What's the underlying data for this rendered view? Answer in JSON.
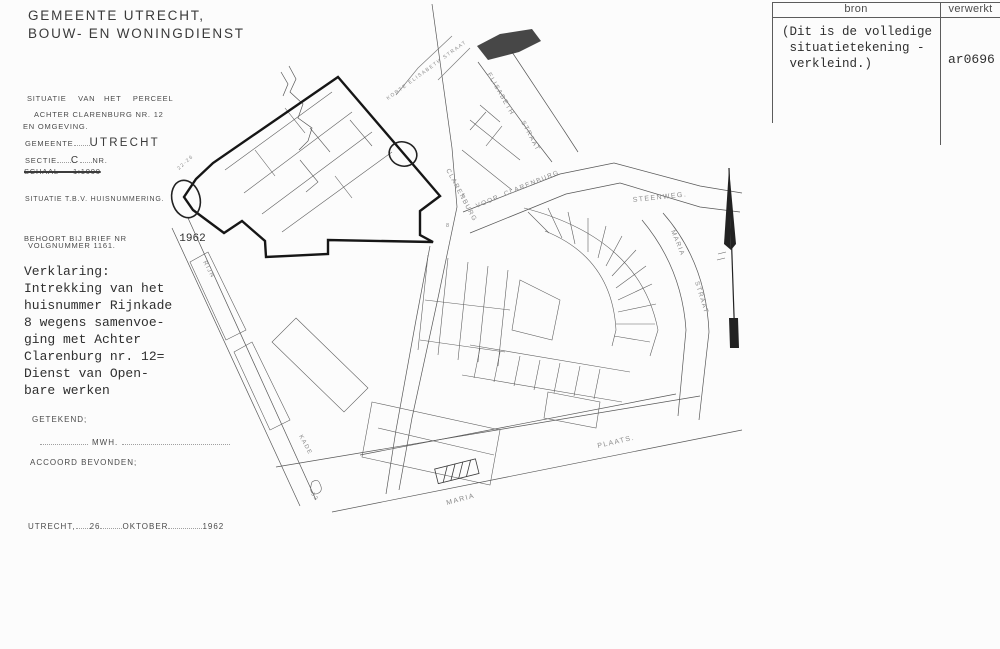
{
  "colors": {
    "ink": "#3f3f3f",
    "map_line": "#555555",
    "heavy_line": "#141414",
    "label_gray": "#8b8b8b"
  },
  "header": {
    "line1": "GEMEENTE UTRECHT,",
    "line2": "BOUW- EN WONINGDIENST"
  },
  "ref_table": {
    "col_bron": "bron",
    "col_verwerkt": "verwerkt",
    "bron_lines": [
      "(Dit is de volledige",
      " situatietekening -",
      " verkleind.)"
    ],
    "verwerkt_value": "ar0696"
  },
  "form": {
    "situatie_label": "SITUATIE    VAN   HET    PERCEEL",
    "perceel_line1": "ACHTER CLARENBURG NR. 12",
    "perceel_line2": "EN OMGEVING.",
    "gemeente_label": "GEMEENTE",
    "gemeente_value": "UTRECHT",
    "sectie_label": "SECTIE",
    "sectie_value": "C",
    "nr_label": "NR.",
    "schaal_line": "SCHAAL     1:1000",
    "situatie_tbv": "SITUATIE T.B.V. HUISNUMMERING.",
    "behoort_label": "BEHOORT BIJ BRIEF NR",
    "behoort_year": "1962",
    "volgnummer": "VOLGNUMMER 1161.",
    "verklaring_lines": [
      "Verklaring:",
      "Intrekking van het",
      "huisnummer Rijnkade",
      "8 wegens samenvoe-",
      "ging met Achter",
      "Clarenburg nr. 12=",
      "Dienst van Open-",
      "bare werken"
    ],
    "getekend_label": "GETEKEND;",
    "getekend_initials": "MWH.",
    "accoord_label": "ACCOORD BEVONDEN;",
    "date_city": "UTRECHT,",
    "date_day": "26",
    "date_month": "OKTOBER",
    "date_year": "1962"
  },
  "map": {
    "labels": [
      {
        "text": "CLARENBURG"
      },
      {
        "text": "VOOR"
      },
      {
        "text": "CLARENBURG"
      },
      {
        "text": "ELISABETH"
      },
      {
        "text": "STRAAT"
      },
      {
        "text": "KORTE ELISABETH STRAAT"
      },
      {
        "text": "STEENWEG."
      },
      {
        "text": "MARIA"
      },
      {
        "text": "STRAAT"
      },
      {
        "text": "PLAATS."
      },
      {
        "text": "MARIA"
      },
      {
        "text": "RIJN"
      },
      {
        "text": "KADE"
      },
      {
        "text": "22-26"
      },
      {
        "text": "8"
      },
      {
        "text": "6"
      },
      {
        "text": "32"
      }
    ]
  }
}
